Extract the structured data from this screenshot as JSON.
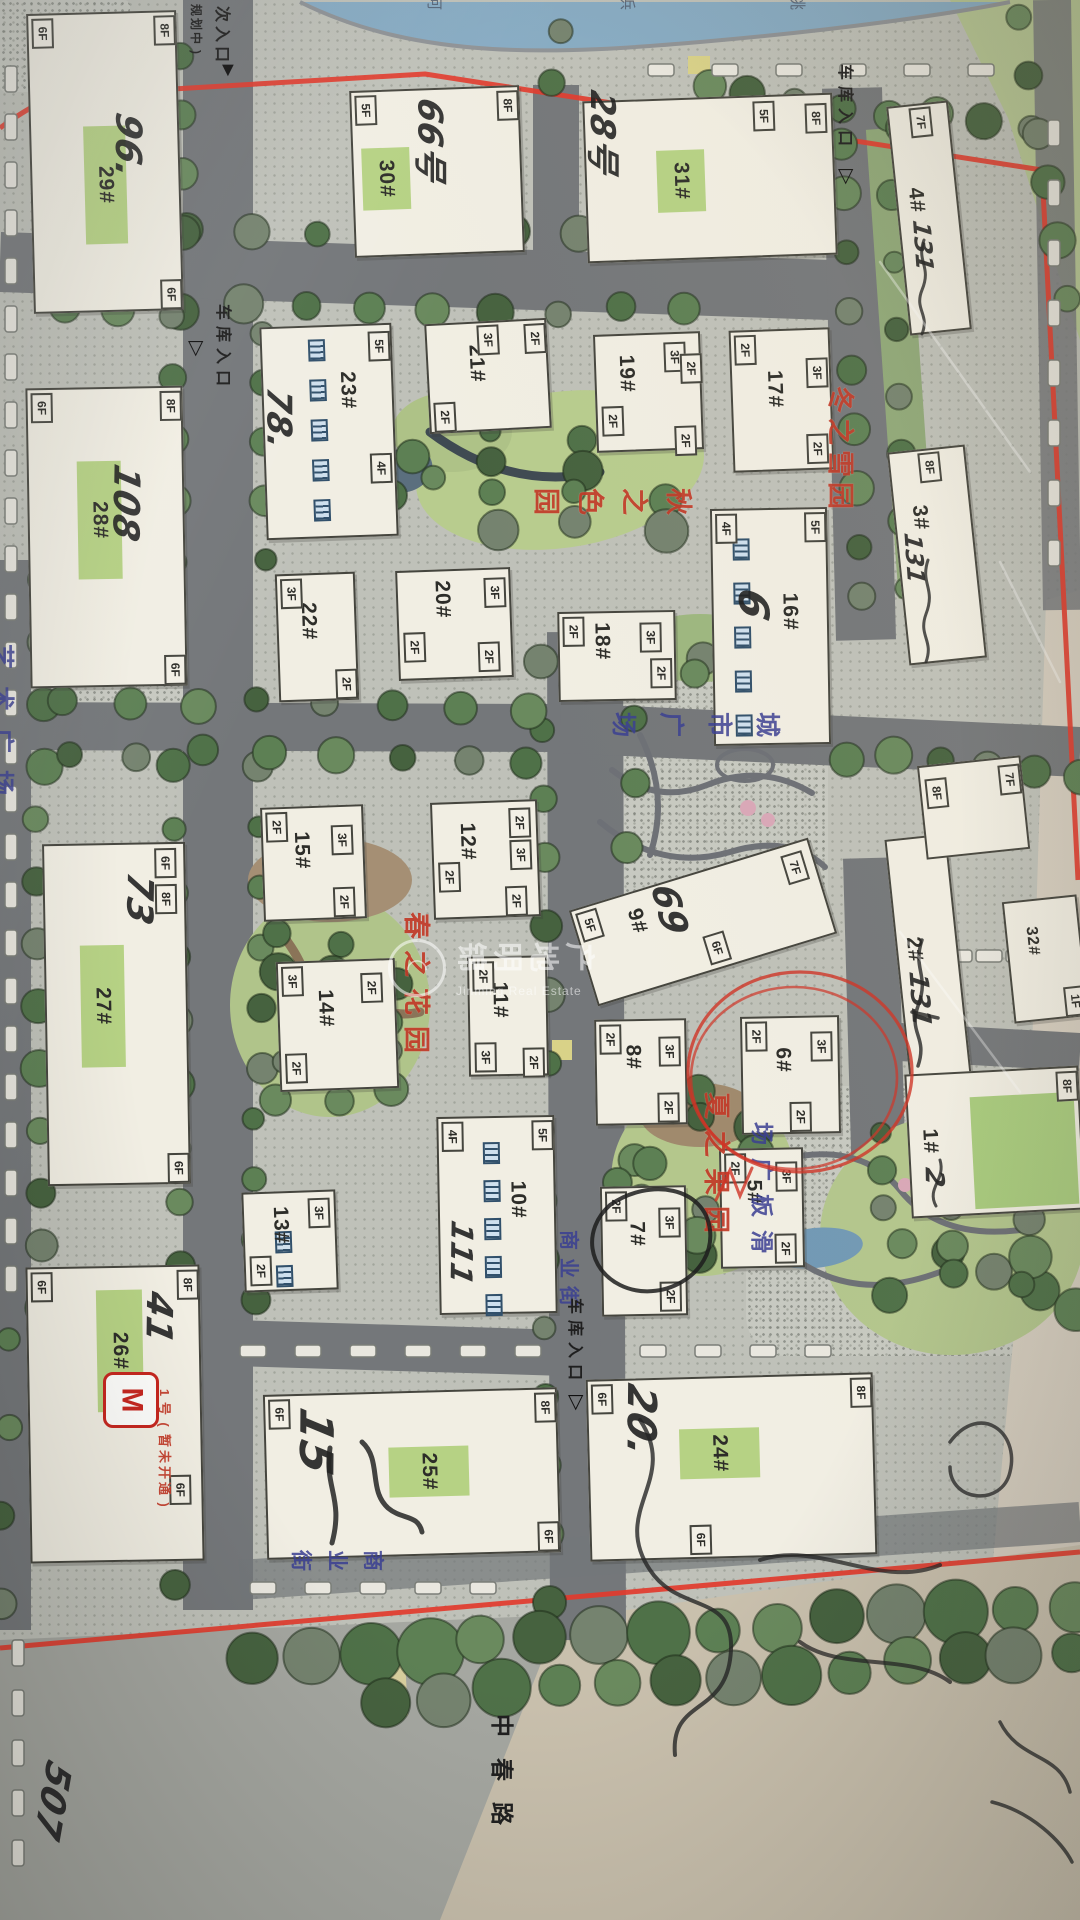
{
  "watermark": {
    "cn": "锦明地产",
    "en": "Jinming Real Estate",
    "logo_glyph": "◠"
  },
  "river_chars": [
    "河",
    "浜",
    "姚"
  ],
  "labels": {
    "side_entrance": "次入口",
    "side_entrance_note": "(规划中)",
    "garage_entrance": "车库入口",
    "city_plaza": "城市广场",
    "art_plaza": "艺术广场",
    "skate_plaza": "滑板广场",
    "commercial_street": "商业街",
    "road_name": "中春路",
    "metro_symbol": "M",
    "metro_note": "1号(暂未开通)"
  },
  "gardens": {
    "winter": "冬之雪园",
    "autumn": "秋之色园",
    "spring": "春之花园",
    "summer": "夏之果园"
  },
  "buildings": [
    {
      "no": "29#",
      "floors": [
        "6F",
        "8F",
        "6F"
      ],
      "annotation": "96."
    },
    {
      "no": "30#",
      "floors": [
        "5F",
        "8F"
      ],
      "annotation": "66号"
    },
    {
      "no": "31#",
      "floors": [
        "5F",
        "8F"
      ],
      "annotation": "28号"
    },
    {
      "no": "4#",
      "floors": [
        "7F"
      ],
      "annotation": "131"
    },
    {
      "no": "28#",
      "floors": [
        "6F",
        "8F",
        "6F"
      ],
      "annotation": "108"
    },
    {
      "no": "23#",
      "floors": [
        "5F",
        "4F"
      ],
      "annotation": "78."
    },
    {
      "no": "21#",
      "floors": [
        "3F",
        "2F",
        "2F"
      ],
      "annotation": ""
    },
    {
      "no": "19#",
      "floors": [
        "3F",
        "2F",
        "2F",
        "2F"
      ],
      "annotation": ""
    },
    {
      "no": "17#",
      "floors": [
        "2F",
        "3F",
        "2F"
      ],
      "annotation": ""
    },
    {
      "no": "3#",
      "floors": [
        "8F"
      ],
      "annotation": "131"
    },
    {
      "no": "20#",
      "floors": [
        "3F",
        "2F",
        "2F"
      ],
      "annotation": ""
    },
    {
      "no": "22#",
      "floors": [
        "3F",
        "2F"
      ],
      "annotation": ""
    },
    {
      "no": "18#",
      "floors": [
        "2F",
        "3F",
        "2F"
      ],
      "annotation": ""
    },
    {
      "no": "16#",
      "floors": [
        "4F",
        "5F"
      ],
      "annotation": "6"
    },
    {
      "no": "27#",
      "floors": [
        "6F",
        "8F",
        "6F"
      ],
      "annotation": "73"
    },
    {
      "no": "15#",
      "floors": [
        "2F",
        "3F",
        "2F"
      ],
      "annotation": ""
    },
    {
      "no": "12#",
      "floors": [
        "2F",
        "3F",
        "2F",
        "2F"
      ],
      "annotation": ""
    },
    {
      "no": "9#",
      "floors": [
        "5F",
        "7F",
        "6F"
      ],
      "annotation": "69"
    },
    {
      "no": "2#",
      "floors": [
        "8F",
        "7F"
      ],
      "annotation": "131"
    },
    {
      "no": "32#",
      "floors": [
        "1F"
      ],
      "annotation": ""
    },
    {
      "no": "1#",
      "floors": [
        "8F"
      ],
      "annotation": "2"
    },
    {
      "no": "14#",
      "floors": [
        "3F",
        "2F",
        "2F"
      ],
      "annotation": ""
    },
    {
      "no": "11#",
      "floors": [
        "2F",
        "3F",
        "2F"
      ],
      "annotation": ""
    },
    {
      "no": "8#",
      "floors": [
        "2F",
        "3F",
        "2F"
      ],
      "annotation": ""
    },
    {
      "no": "6#",
      "floors": [
        "2F",
        "3F",
        "2F"
      ],
      "annotation": ""
    },
    {
      "no": "5#",
      "floors": [
        "2F",
        "3F",
        "2F"
      ],
      "annotation": ""
    },
    {
      "no": "7#",
      "floors": [
        "2F",
        "3F",
        "2F"
      ],
      "annotation": "卜"
    },
    {
      "no": "13#",
      "floors": [
        "3F",
        "2F"
      ],
      "annotation": ""
    },
    {
      "no": "10#",
      "floors": [
        "4F",
        "5F"
      ],
      "annotation": "111"
    },
    {
      "no": "26#",
      "floors": [
        "6F",
        "8F",
        "6F"
      ],
      "annotation": "41"
    },
    {
      "no": "25#",
      "floors": [
        "6F",
        "8F",
        "6F"
      ],
      "annotation": "15"
    },
    {
      "no": "24#",
      "floors": [
        "6F",
        "8F",
        "6F"
      ],
      "annotation": "20."
    }
  ],
  "extra_scribbles": [
    "507"
  ]
}
